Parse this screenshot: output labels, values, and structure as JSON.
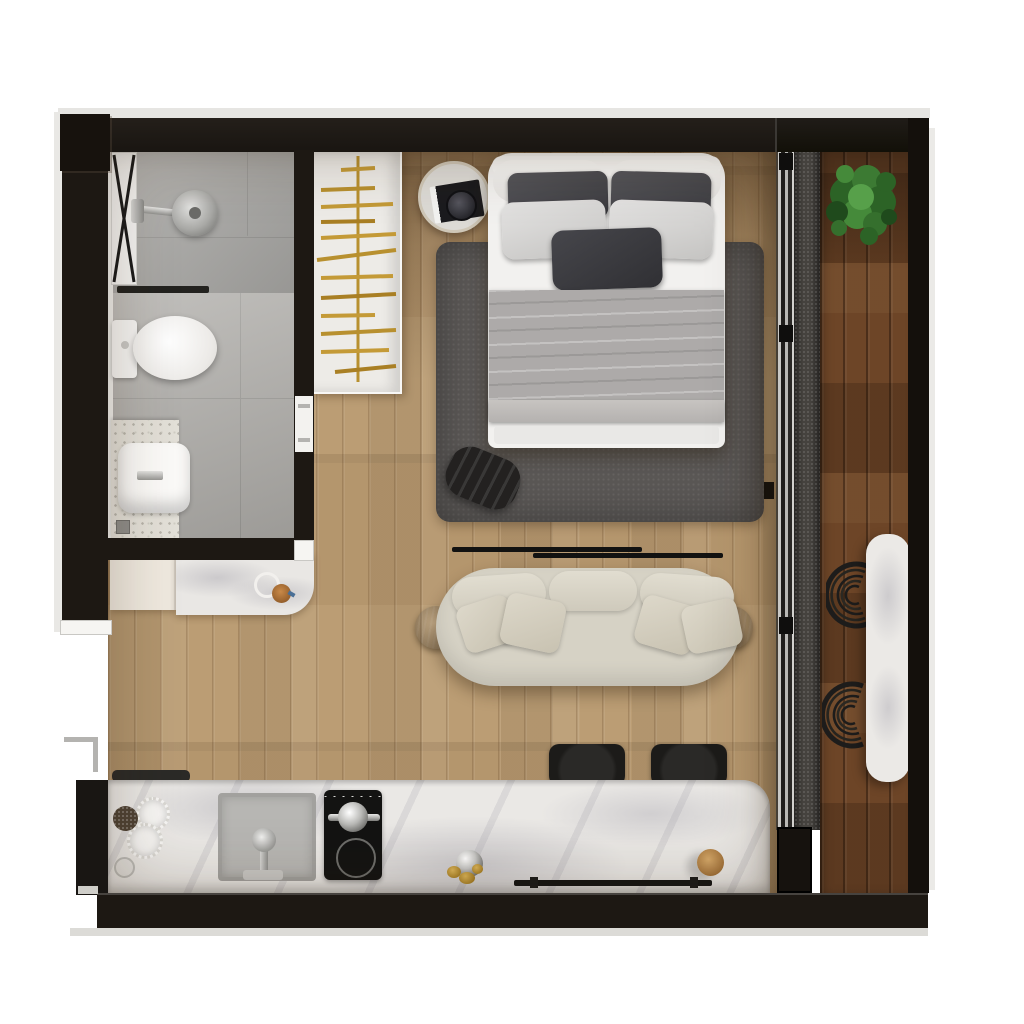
{
  "scene": {
    "type": "studio-apartment-floor-plan-3d-render",
    "view": "top-down",
    "visible_text": "none"
  },
  "palette": {
    "exterior": "#ffffff",
    "walls": "#1d1813",
    "oak_floor": "#bb9d74",
    "walnut_balcony_floor": "#6d4527",
    "marble": "#eae8e5",
    "rug": "#5a5755",
    "sofa": "#d6d2c5",
    "bed_linen": "#f2f1ef",
    "blanket": "#adaaa9",
    "brass_hangers": "#b8902f",
    "plant_green": "#3c7a33",
    "bathroom_tile": "#aaa9a6",
    "terrazzo": "#e3e0d8",
    "black_furniture": "#1c1b19"
  },
  "surfaces": {
    "oak_floor": "background-color:#bb9d74",
    "walnut_floor": "background-color:#6d4527",
    "rug": "background-color:#5a5755",
    "sofa": "background-color:#d6d2c5",
    "island_marble": "background-color:#eae8e5",
    "balcony_table_marble": "background-color:#ebe9e6",
    "bed_frame": "background-color:#f2f1ef",
    "blanket": "background-color:#adaaa9"
  },
  "rooms": {
    "bathroom": {
      "items": [
        "shower-glass-door",
        "rain-shower-head",
        "shower-valve",
        "linear-drain",
        "toilet",
        "terrazzo-vanity",
        "basin-sink",
        "floor-drain"
      ]
    },
    "sleeping_area": {
      "items": [
        "open-wardrobe-with-brass-hangers",
        "round-nightstand",
        "book-and-clock",
        "double-bed",
        "area-rug",
        "leather-pouf"
      ]
    },
    "living_area": {
      "items": [
        "curved-three-seat-sofa",
        "four-throw-pillows",
        "two-round-end-tables",
        "two-wall-rails"
      ]
    },
    "kitchen": {
      "items": [
        "marble-island",
        "runner-mat",
        "undermount-sink",
        "faucet",
        "induction-cooktop",
        "kettle",
        "two-bar-stools",
        "serving-bowls",
        "decor-sphere",
        "pepper-grinder",
        "towel-rail"
      ]
    },
    "balcony": {
      "items": [
        "sliding-glass-door-track",
        "threshold",
        "potted-plant",
        "marble-console-table",
        "two-woven-lounge-chairs"
      ]
    },
    "entry": {
      "items": [
        "console-cabinet",
        "marble-console-top",
        "coffee-cup",
        "cup-ring",
        "entry-door-frame"
      ]
    }
  }
}
